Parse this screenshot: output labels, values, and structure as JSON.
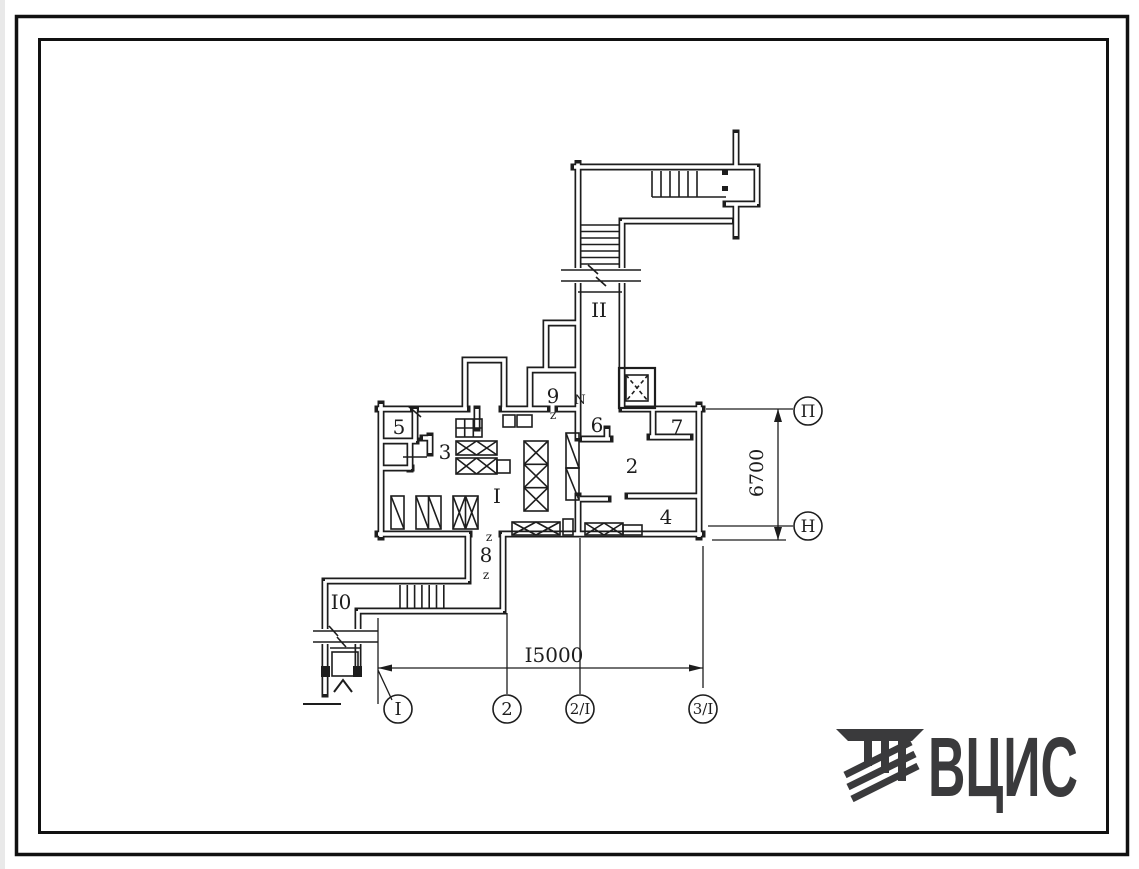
{
  "plan": {
    "room_labels": [
      {
        "room": "1",
        "label": "I"
      },
      {
        "room": "2",
        "label": "2"
      },
      {
        "room": "3",
        "label": "3"
      },
      {
        "room": "4",
        "label": "4"
      },
      {
        "room": "5",
        "label": "5"
      },
      {
        "room": "6",
        "label": "6"
      },
      {
        "room": "7",
        "label": "7"
      },
      {
        "room": "8",
        "label": "8"
      },
      {
        "room": "9",
        "label": "9"
      },
      {
        "room": "10",
        "label": "I0"
      },
      {
        "room": "11",
        "label": "II"
      }
    ],
    "door_marks": [
      {
        "label": "N"
      },
      {
        "label": "z"
      },
      {
        "label": "z"
      },
      {
        "label": "z"
      }
    ],
    "dimensions": {
      "horizontal": "I5000",
      "vertical": "6700"
    },
    "axis_markers": {
      "bottom": [
        {
          "label": "I"
        },
        {
          "label": "2"
        },
        {
          "label": "2/I"
        },
        {
          "label": "3/I"
        }
      ],
      "right": [
        {
          "label": "П"
        },
        {
          "label": "Н"
        }
      ]
    }
  },
  "logo": {
    "text": "ВЦИС",
    "color": "#3a3a3c"
  },
  "colors": {
    "ink": "#1d1d1d",
    "paper": "#ffffff"
  }
}
